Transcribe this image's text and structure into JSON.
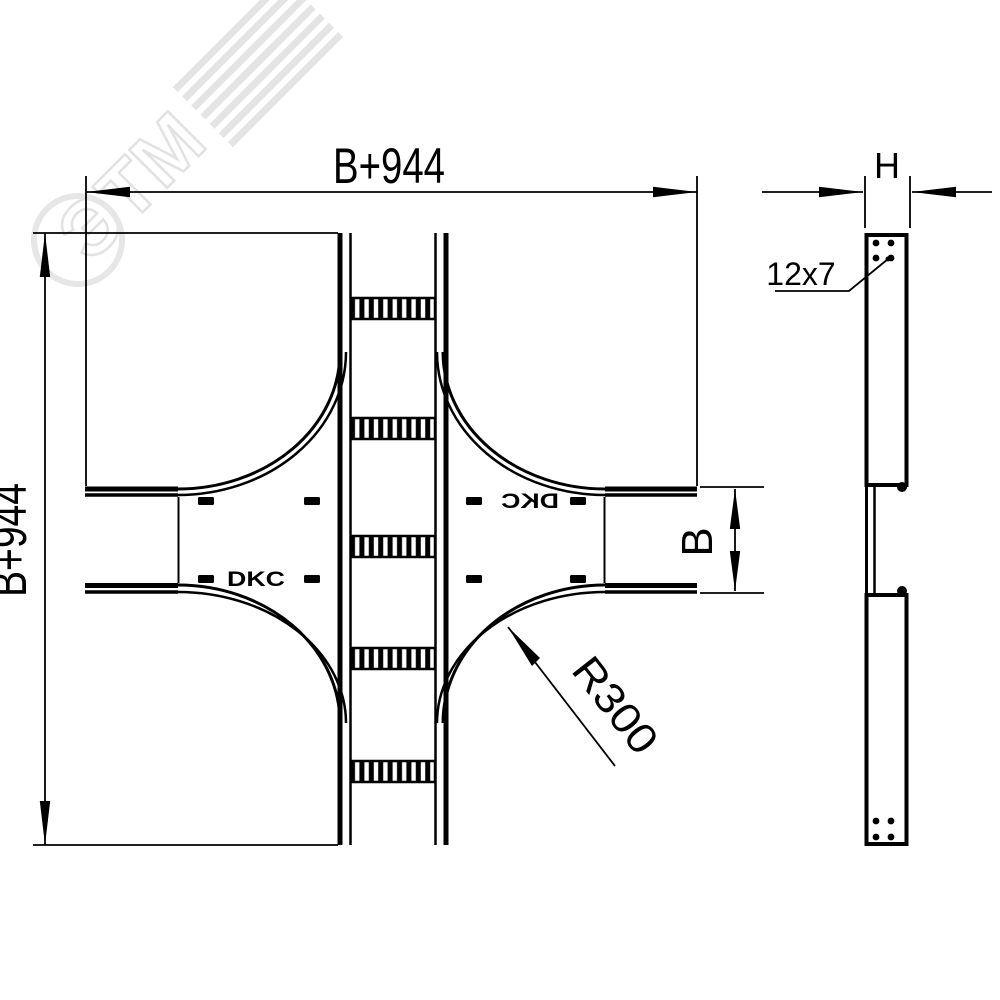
{
  "labels": {
    "width_top": "B+944",
    "height_left": "B+944",
    "tray_width": "B",
    "side_thickness": "H",
    "bend_radius": "R300",
    "slot_size": "12x7",
    "brand_left": "DKC",
    "brand_right": "DKC",
    "watermark": "ЭТМ"
  },
  "colors": {
    "line": "#000000",
    "background": "#ffffff",
    "watermark": "#e4e4e4"
  }
}
